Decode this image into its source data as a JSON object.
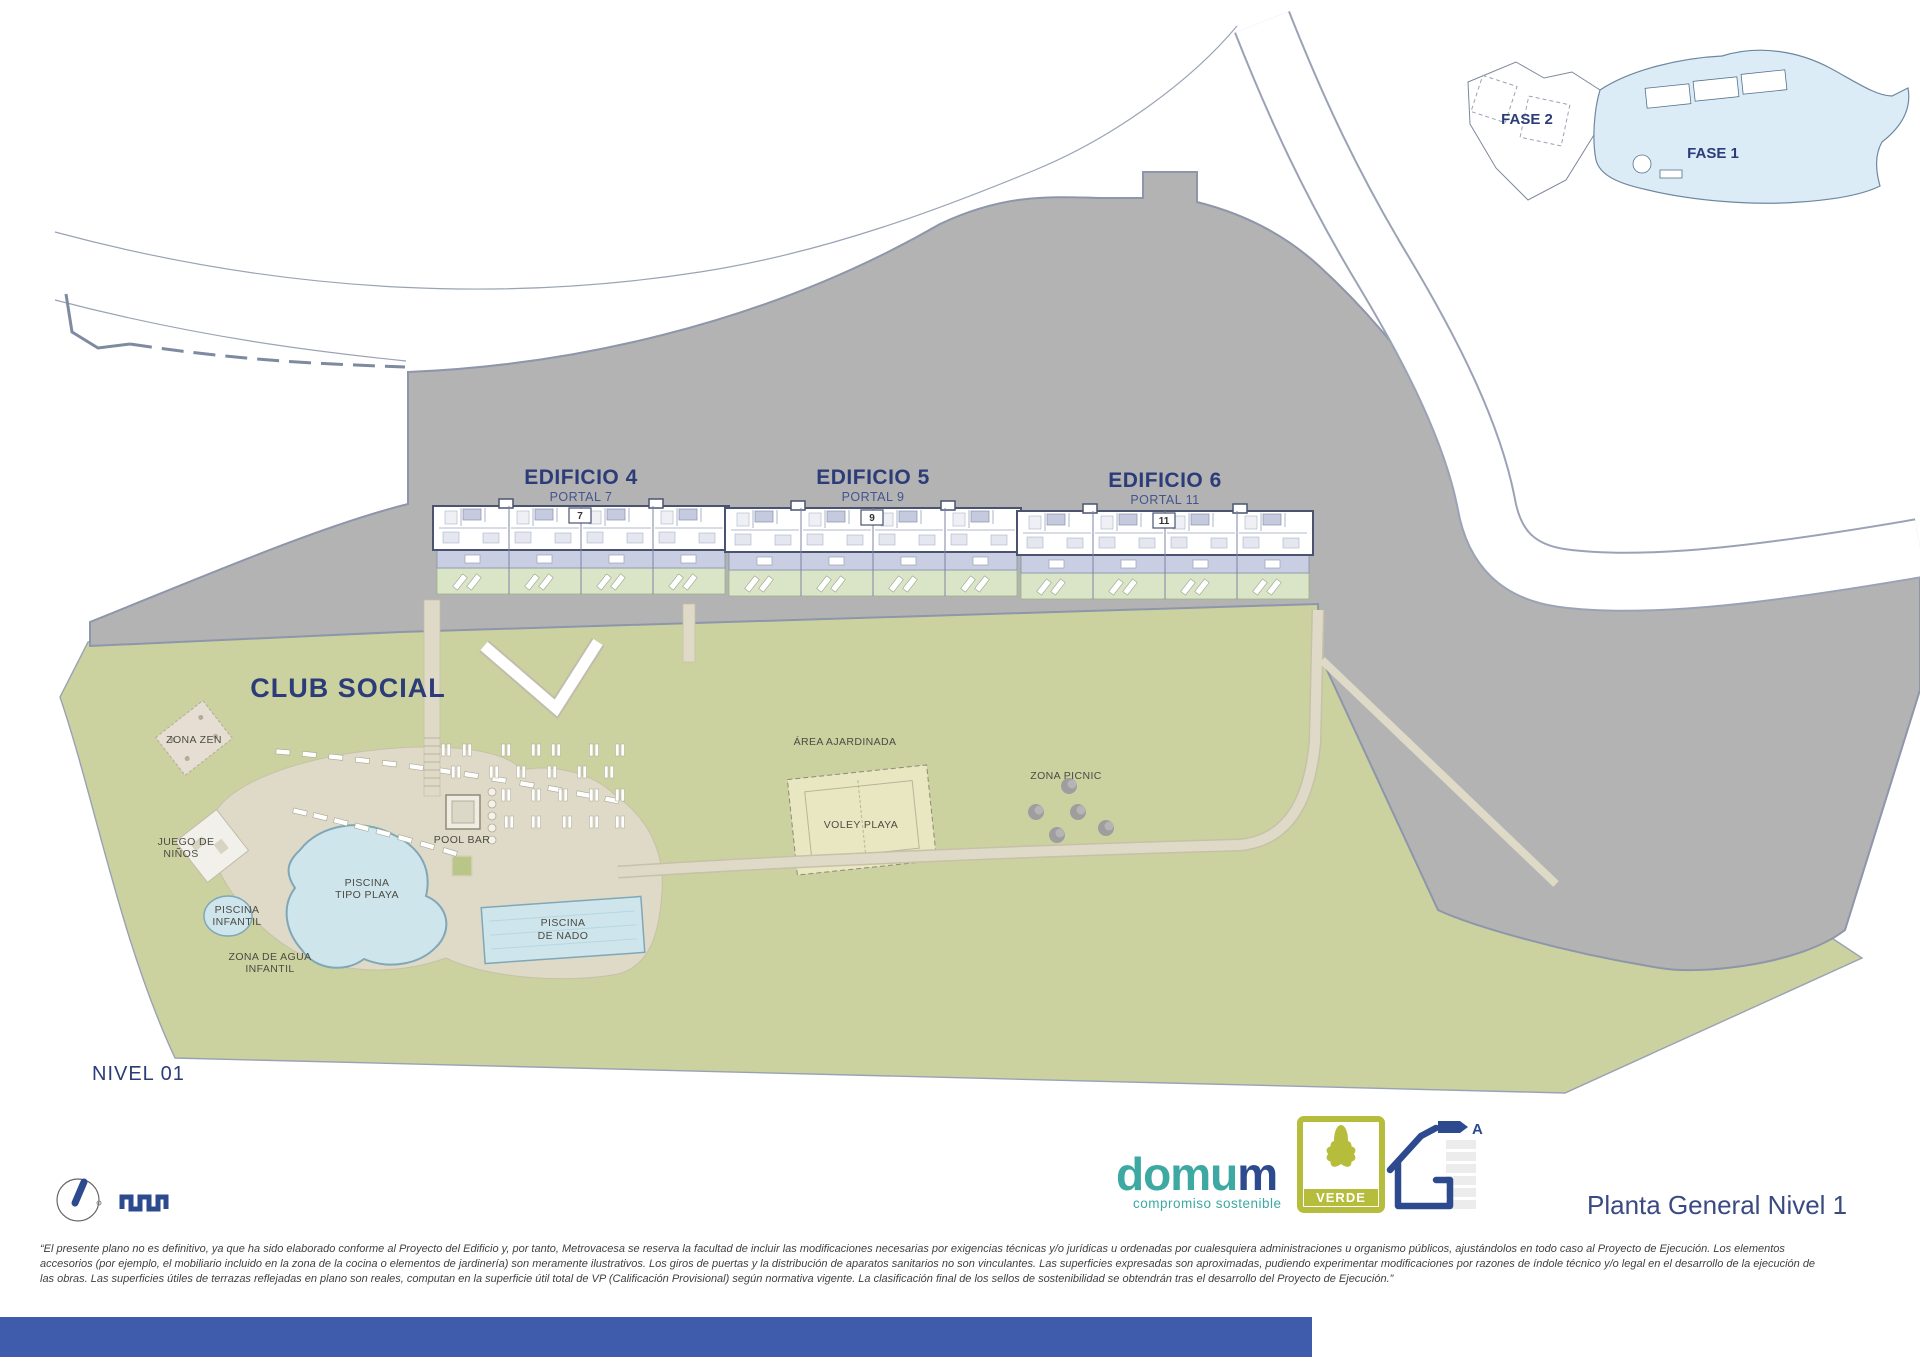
{
  "colors": {
    "terrain_gray": "#b3b3b3",
    "terrain_edge": "#8d96aa",
    "lawn_green": "#cbd2a0",
    "garden_green": "#d9e5c6",
    "path_beige": "#dedac7",
    "pool_blue": "#cfe5ec",
    "pool_edge": "#7fa7b8",
    "terrace_lavender": "#c9cee3",
    "navy": "#2b3c78",
    "teal": "#3ea8a2",
    "verde_green": "#b6bd3c",
    "bottom_bar_blue": "#3e5cab",
    "inset_blue": "#dcecf7",
    "sand": "#e9e7c2"
  },
  "inset": {
    "fase2_label": "FASE 2",
    "fase1_label": "FASE 1"
  },
  "buildings": [
    {
      "name": "EDIFICIO 4",
      "portal": "PORTAL 7",
      "portal_number": "7"
    },
    {
      "name": "EDIFICIO 5",
      "portal": "PORTAL 9",
      "portal_number": "9"
    },
    {
      "name": "EDIFICIO 6",
      "portal": "PORTAL 11",
      "portal_number": "11"
    }
  ],
  "site": {
    "club_social": "CLUB SOCIAL",
    "zona_zen": "ZONA ZEN",
    "juego_de_ninos": [
      "JUEGO DE",
      "NIÑOS"
    ],
    "piscina_infantil": [
      "PISCINA",
      "INFANTIL"
    ],
    "piscina_tipo_playa": [
      "PISCINA",
      "TIPO PLAYA"
    ],
    "zona_agua_infantil": [
      "ZONA DE AGUA",
      "INFANTIL"
    ],
    "pool_bar": "POOL BAR",
    "piscina_de_nado": [
      "PISCINA",
      "DE NADO"
    ],
    "area_ajardinada": "ÁREA AJARDINADA",
    "voley_playa": "VOLEY PLAYA",
    "zona_picnic": "ZONA PICNIC"
  },
  "level_label": "NIVEL 01",
  "title": "Planta General Nivel 1",
  "logo": {
    "brand_main": "domu",
    "brand_last": "m",
    "tagline": "compromiso sostenible",
    "badge_label": "VERDE",
    "energy_rating": "A"
  },
  "disclaimer": [
    "“El presente plano no es definitivo, ya que ha sido elaborado conforme al Proyecto del Edificio y, por tanto, Metrovacesa se reserva la facultad de incluir las modificaciones necesarias por exigencias técnicas y/o jurídicas u ordenadas por cualesquiera administraciones u organismo públicos, ajustándolos en todo caso al Proyecto de Ejecución. Los elementos",
    "accesorios (por ejemplo, el mobiliario incluido en la zona de la cocina o elementos de jardinería) son meramente ilustrativos. Los giros de puertas y la distribución de aparatos sanitarios no son vinculantes. Las superficies expresadas son aproximadas, pudiendo experimentar modificaciones por razones de índole técnico y/o legal en el desarrollo de la ejecución de",
    "las obras. Las superficies útiles de terrazas reflejadas en plano son reales, computan en la superficie útil total de VP (Calificación Provisional) según normativa vigente. La clasificación final de los sellos de sostenibilidad se obtendrán tras el desarrollo del Proyecto de Ejecución.”"
  ]
}
